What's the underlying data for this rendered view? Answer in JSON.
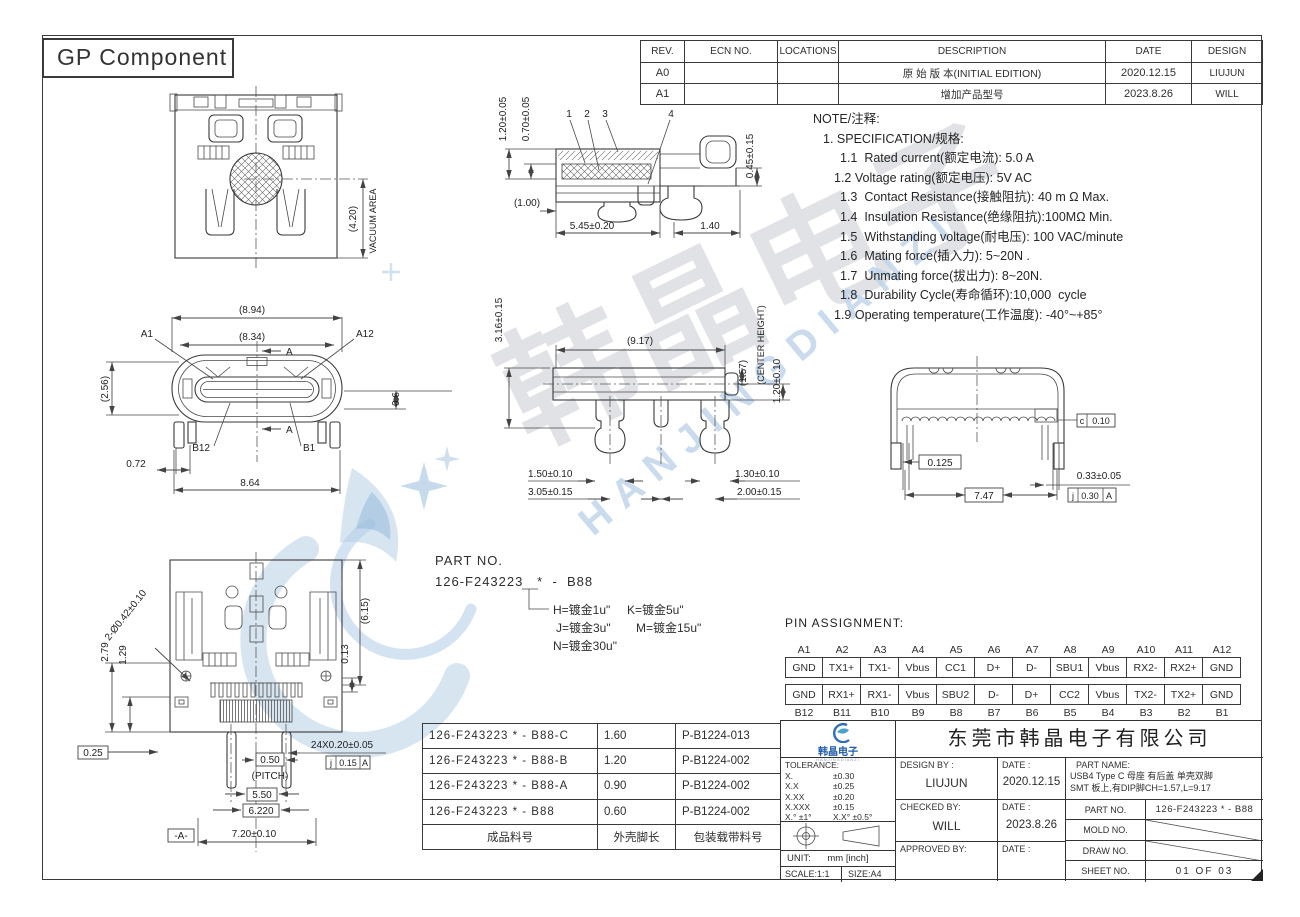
{
  "sheet": {
    "title_box": "GP Component"
  },
  "watermark": {
    "cn": "韩晶电子",
    "en": "HANJINGDIANZI"
  },
  "revision_table": {
    "headers": [
      "REV.",
      "ECN NO.",
      "LOCATIONS",
      "DESCRIPTION",
      "DATE",
      "DESIGN"
    ],
    "rows": [
      {
        "rev": "A0",
        "ecn": "",
        "loc": "",
        "desc": "原 始 版 本(INITIAL EDITION)",
        "date": "2020.12.15",
        "design": "LIUJUN"
      },
      {
        "rev": "A1",
        "ecn": "",
        "loc": "",
        "desc": "增加产品型号",
        "date": "2023.8.26",
        "design": "WILL"
      }
    ]
  },
  "notes": {
    "title": "NOTE/注释:",
    "spec_title": "1. SPECIFICATION/规格:",
    "items": [
      "1.1  Rated current(额定电流): 5.0 A",
      "1.2 Voltage rating(额定电压): 5V AC",
      "1.3  Contact Resistance(接触阻抗): 40 m Ω Max.",
      "1.4  Insulation Resistance(绝缘阻抗):100MΩ Min.",
      "1.5  Withstanding voltage(耐电压): 100 VAC/minute",
      "1.6  Mating force(插入力): 5~20N .",
      "1.7  Unmating force(拔出力): 8~20N.",
      "1.8  Durability Cycle(寿命循环):10,000  cycle",
      "1.9 Operating temperature(工作温度): -40°~+85°"
    ]
  },
  "views": {
    "top_view": {
      "d_420": "(4.20)",
      "vacuum": "VACUUM AREA"
    },
    "side_section": {
      "c1": "1",
      "c2": "2",
      "c3": "3",
      "c4": "4",
      "d_120": "1.20±0.05",
      "d_070": "0.70±0.05",
      "d_045": "0.45±0.15",
      "d_100": "(1.00)",
      "d_545": "5.45±0.20",
      "d_140": "1.40"
    },
    "front_view": {
      "d_894": "(8.94)",
      "d_834": "(8.34)",
      "a1": "A1",
      "a12": "A12",
      "b12": "B12",
      "b1": "B1",
      "sec": "A",
      "d_256": "(2.56)",
      "d_06": "0.6",
      "d_072": "0.72",
      "d_864": "8.64"
    },
    "section_aa": {
      "d_316": "3.16±0.15",
      "d_917": "(9.17)",
      "d_157": "(1.57)",
      "center_height": "(CENTER HEIGHT)",
      "d_120": "1.20±0.10",
      "d_150": "1.50±0.10",
      "d_305": "3.05±0.15",
      "d_130": "1.30±0.10",
      "d_200": "2.00±0.15"
    },
    "rear_view": {
      "f_c": "c",
      "f_c_val": "0.10",
      "d_0125": "0.125",
      "d_747": "7.47",
      "d_033": "0.33±0.05",
      "f_j": "j",
      "f_j_val": "0.30",
      "f_j_ref": "A"
    },
    "bottom_view": {
      "d_hole": "2-Ø0.42±0.10",
      "d_279": "2.79",
      "d_129": "1.29",
      "d_615": "(6.15)",
      "d_013": "0.13",
      "d_025": "0.25",
      "d_24x": "24X0.20±0.05",
      "d_050": "0.50",
      "pitch": "(PITCH)",
      "f_j": "j",
      "f_j_val": "0.15",
      "f_j_ref": "A",
      "d_550": "5.50",
      "d_6220": "6.220",
      "datum": "-A-",
      "d_720": "7.20±0.10"
    }
  },
  "part_legend": {
    "label": "PART NO.",
    "number": "126-F243223   *  -  B88",
    "options": [
      "H=镀金1u\"",
      "K=镀金5u\"",
      "J=镀金3u\"",
      "M=镀金15u\"",
      "N=镀金30u\""
    ]
  },
  "pin_assignment": {
    "title": "PIN ASSIGNMENT:",
    "top_labels": [
      "A1",
      "A2",
      "A3",
      "A4",
      "A5",
      "A6",
      "A7",
      "A8",
      "A9",
      "A10",
      "A11",
      "A12"
    ],
    "row_a": [
      "GND",
      "TX1+",
      "TX1-",
      "Vbus",
      "CC1",
      "D+",
      "D-",
      "SBU1",
      "Vbus",
      "RX2-",
      "RX2+",
      "GND"
    ],
    "row_b": [
      "GND",
      "RX1+",
      "RX1-",
      "Vbus",
      "SBU2",
      "D-",
      "D+",
      "CC2",
      "Vbus",
      "TX2-",
      "TX2+",
      "GND"
    ],
    "bottom_labels": [
      "B12",
      "B11",
      "B10",
      "B9",
      "B8",
      "B7",
      "B6",
      "B5",
      "B4",
      "B3",
      "B2",
      "B1"
    ]
  },
  "material_table": {
    "rows": [
      [
        "126-F243223  *  - B88-C",
        "1.60",
        "P-B1224-013"
      ],
      [
        "126-F243223  *  - B88-B",
        "1.20",
        "P-B1224-002"
      ],
      [
        "126-F243223  *  - B88-A",
        "0.90",
        "P-B1224-002"
      ],
      [
        "126-F243223  *  - B88",
        "0.60",
        "P-B1224-002"
      ]
    ],
    "footer": [
      "成品料号",
      "外壳脚长",
      "包装载带料号"
    ]
  },
  "title_block": {
    "company": "东莞市韩晶电子有限公司",
    "logo_text": "韩晶电子",
    "logo_sub": "HANJINGDIANZI",
    "tolerance_label": "TOLERANCE:",
    "tol_rows": [
      {
        "l": "X.",
        "v": "±0.30"
      },
      {
        "l": "X.X",
        "v": "±0.25"
      },
      {
        "l": "X.XX",
        "v": "±0.20"
      },
      {
        "l": "X.XXX",
        "v": "±0.15"
      },
      {
        "l": "X.°  ±1°",
        "v": "X.X°  ±0.5°"
      }
    ],
    "unit_label": "UNIT:",
    "unit_value": "mm [inch]",
    "scale": "SCALE:1:1",
    "size": "SIZE:A4",
    "design_by_label": "DESIGN BY :",
    "design_by": "LIUJUN",
    "date_label": "DATE :",
    "design_date": "2020.12.15",
    "checked_by_label": "CHECKED BY:",
    "checked_by": "WILL",
    "checked_date": "2023.8.26",
    "approved_by_label": "APPROVED BY:",
    "part_name_label": "PART NAME:",
    "part_name_line1": "USB4 Type C  母座 有后盖 单壳双脚",
    "part_name_line2": "SMT 板上,有DIP脚CH=1.57,L=9.17",
    "part_no_label": "PART NO.",
    "part_no": "126-F243223  *  - B88",
    "mold_no_label": "MOLD NO.",
    "draw_no_label": "DRAW NO.",
    "sheet_no_label": "SHEET NO.",
    "sheet_no": "01 OF 03"
  }
}
